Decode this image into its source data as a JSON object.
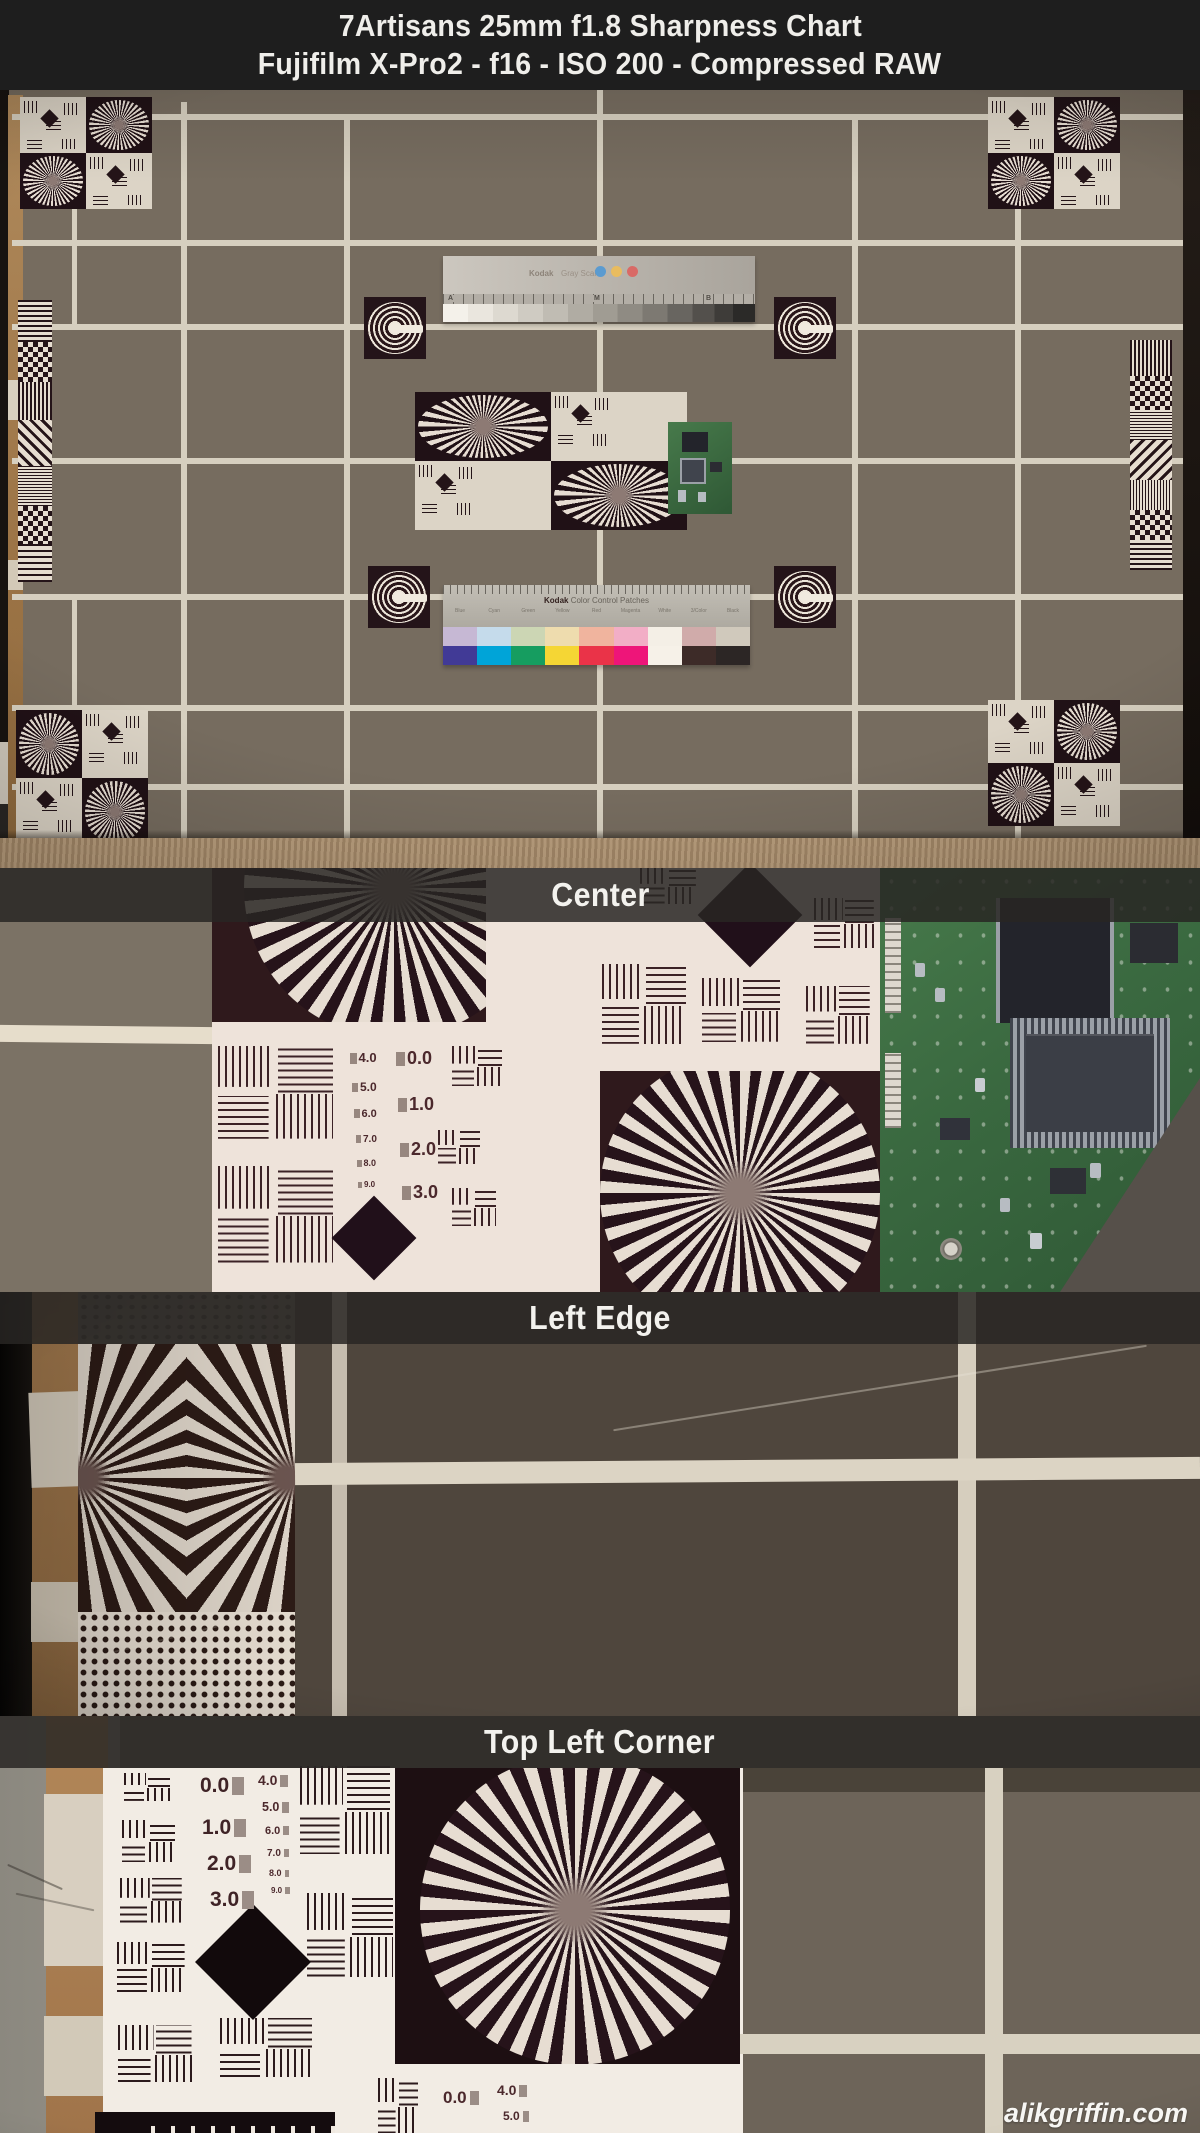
{
  "header": {
    "line1": "7Artisans 25mm f1.8 Sharpness Chart",
    "line2": "Fujifilm X-Pro2 - f16 - ISO 200 - Compressed RAW"
  },
  "sections": [
    {
      "label": "Center"
    },
    {
      "label": "Left Edge"
    },
    {
      "label": "Top Left Corner"
    }
  ],
  "watermark": "alikgriffin.com",
  "gray_scale_ruler": {
    "brand": "Kodak",
    "label": "Gray Scale",
    "tick_letters": [
      "A",
      "M",
      "B"
    ]
  },
  "color_patches": {
    "brand": "Kodak",
    "label": "Color Control Patches",
    "columns": [
      "Blue",
      "Cyan",
      "Green",
      "Yellow",
      "Red",
      "Magenta",
      "White",
      "3/Color",
      "Black"
    ],
    "row_pastel": [
      "#c6b8d4",
      "#c5dbeb",
      "#ccd6b4",
      "#eedcae",
      "#f0b49e",
      "#f2aec6",
      "#f4efe6",
      "#d0abaa",
      "#d0c9bc"
    ],
    "row_saturated": [
      "#413a96",
      "#00a4d8",
      "#169d60",
      "#f5d634",
      "#ea3348",
      "#ee1579",
      "#f6f1e8",
      "#3d2b28",
      "#2c2625"
    ]
  },
  "center_crop": {
    "numbers_large": [
      "0.0",
      "1.0",
      "2.0",
      "3.0"
    ],
    "numbers_small": [
      "4.0",
      "5.0",
      "6.0",
      "7.0",
      "8.0",
      "9.0"
    ]
  },
  "corner_crop": {
    "numbers_large": [
      "0.0",
      "1.0",
      "2.0",
      "3.0"
    ],
    "numbers_small": [
      "4.0",
      "5.0",
      "6.0",
      "7.0",
      "8.0",
      "9.0"
    ],
    "numbers_bottom": [
      "0.0",
      "4.0",
      "5.0"
    ]
  },
  "colors": {
    "header_bg": "#1e1e1e",
    "band_bg": "rgba(40,38,35,0.85)",
    "wall": "#766c5f",
    "wall_dark": "#4f463d",
    "grid_line": "#d6cfbf",
    "chart_white": "#eee3da",
    "chart_dark": "#2f191c",
    "pcb_green": "#3d6e44",
    "carpet": "#b29674",
    "wood": "#ab8155"
  }
}
